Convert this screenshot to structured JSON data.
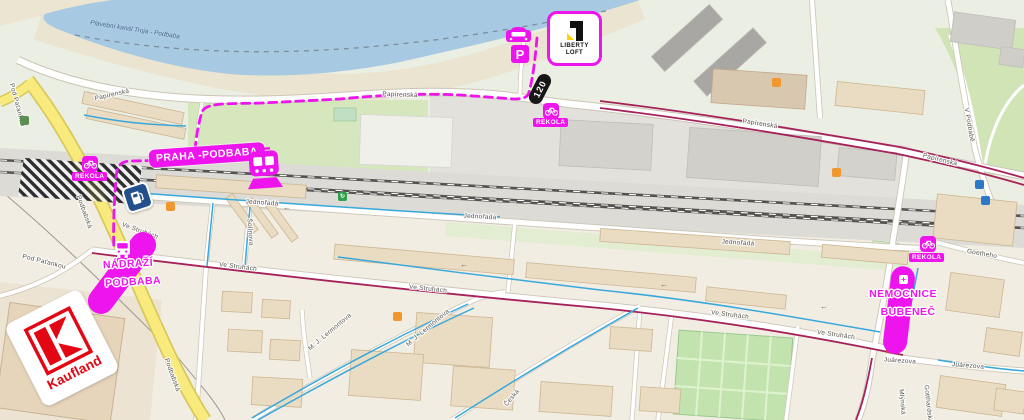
{
  "colors": {
    "accent": "#EE14EE",
    "river": "#A7C9E2",
    "yellow_road": "#F8EA7D",
    "yellow_casing": "#D9C85A",
    "cycle_maroon": "#A6215A",
    "cycle_blue": "#38A8DC",
    "kaufland_red": "#E30613",
    "fuel_blue": "#23508C",
    "railway": "#53524E"
  },
  "map": {
    "river_label": "Plavební kanál Troja - Podbaba"
  },
  "markers": {
    "praha_podbaba": {
      "label": "PRAHA -PODBABA"
    },
    "nadrazi_podbaba": {
      "line1": "NÁDRAŽÍ",
      "line2": "PODBABA"
    },
    "nemocnice_bubenec": {
      "line1": "NEMOCNICE",
      "line2": "BUBENEČ"
    },
    "rekola_top": {
      "label": "REKOLA"
    },
    "rekola_left": {
      "label": "REKOLA"
    },
    "rekola_right": {
      "label": "REKOLA"
    },
    "liberty_loft": {
      "line1": "LIBERTY",
      "line2": "LOFT"
    },
    "route_120": {
      "label": "120"
    },
    "parking": {
      "label": "P"
    },
    "kaufland": {
      "label": "Kaufland"
    }
  },
  "street_labels": [
    {
      "text": "Papírenská",
      "x": 112,
      "y": 95,
      "rot": -13
    },
    {
      "text": "Papírenská",
      "x": 400,
      "y": 95,
      "rot": 2
    },
    {
      "text": "Papírenská",
      "x": 760,
      "y": 124,
      "rot": 9
    },
    {
      "text": "Papírenská",
      "x": 940,
      "y": 160,
      "rot": 14
    },
    {
      "text": "Jednořadá",
      "x": 262,
      "y": 203,
      "rot": 4
    },
    {
      "text": "Jednořadá",
      "x": 480,
      "y": 217,
      "rot": 3
    },
    {
      "text": "Jednořadá",
      "x": 738,
      "y": 243,
      "rot": 4
    },
    {
      "text": "Ve Struhách",
      "x": 140,
      "y": 231,
      "rot": 20
    },
    {
      "text": "Ve Struhách",
      "x": 238,
      "y": 267,
      "rot": 7
    },
    {
      "text": "Ve Struhách",
      "x": 428,
      "y": 289,
      "rot": 6
    },
    {
      "text": "Ve Struhách",
      "x": 730,
      "y": 315,
      "rot": 7
    },
    {
      "text": "Ve Struhách",
      "x": 836,
      "y": 335,
      "rot": 8
    },
    {
      "text": "Podbabská",
      "x": 84,
      "y": 212,
      "rot": 70
    },
    {
      "text": "Podbabská",
      "x": 172,
      "y": 375,
      "rot": 70
    },
    {
      "text": "Pod Paťankou",
      "x": 17,
      "y": 105,
      "rot": 75
    },
    {
      "text": "Pod Paťankou",
      "x": 44,
      "y": 262,
      "rot": 14
    },
    {
      "text": "Šolínova",
      "x": 250,
      "y": 232,
      "rot": 86
    },
    {
      "text": "M. J. Lermontova",
      "x": 330,
      "y": 332,
      "rot": -40
    },
    {
      "text": "M. J. Lermontova",
      "x": 428,
      "y": 328,
      "rot": -40
    },
    {
      "text": "Česká",
      "x": 512,
      "y": 398,
      "rot": -50
    },
    {
      "text": "Juárezova",
      "x": 900,
      "y": 361,
      "rot": 4
    },
    {
      "text": "Juárezova",
      "x": 968,
      "y": 366,
      "rot": 5
    },
    {
      "text": "Goetheho",
      "x": 982,
      "y": 254,
      "rot": 10
    },
    {
      "text": "Mlýnská",
      "x": 902,
      "y": 402,
      "rot": 85
    },
    {
      "text": "Gotthardská",
      "x": 928,
      "y": 404,
      "rot": 84
    },
    {
      "text": "V Podbabě",
      "x": 969,
      "y": 125,
      "rot": 80
    }
  ],
  "poi_icons": [
    {
      "name": "recycling-icon",
      "x": 338,
      "y": 192,
      "bg": "#2FA04C",
      "glyph": "↻"
    },
    {
      "name": "shop-icon",
      "x": 166,
      "y": 202,
      "bg": "#F0972E",
      "glyph": ""
    },
    {
      "name": "shop-icon",
      "x": 393,
      "y": 312,
      "bg": "#F0972E",
      "glyph": ""
    },
    {
      "name": "shop-icon",
      "x": 772,
      "y": 78,
      "bg": "#F0972E",
      "glyph": ""
    },
    {
      "name": "shop-icon",
      "x": 832,
      "y": 168,
      "bg": "#F0972E",
      "glyph": ""
    },
    {
      "name": "transit-icon",
      "x": 975,
      "y": 180,
      "bg": "#2D78C8",
      "glyph": ""
    },
    {
      "name": "transit-icon",
      "x": 981,
      "y": 196,
      "bg": "#2D78C8",
      "glyph": ""
    },
    {
      "name": "poi-icon",
      "x": 886,
      "y": 344,
      "bg": "#C44536",
      "glyph": ""
    },
    {
      "name": "tree-icon",
      "x": 20,
      "y": 116,
      "bg": "#5B8F52",
      "glyph": ""
    },
    {
      "name": "parking-small-icon",
      "x": 66,
      "y": 372,
      "bg": "#2E6DB4",
      "glyph": "P"
    },
    {
      "name": "oneway-arrow-icon",
      "x": 283,
      "y": 204,
      "bg": "none",
      "glyph": "←"
    },
    {
      "name": "oneway-arrow-icon",
      "x": 460,
      "y": 261,
      "bg": "none",
      "glyph": "←"
    },
    {
      "name": "oneway-arrow-icon",
      "x": 660,
      "y": 281,
      "bg": "none",
      "glyph": "←"
    },
    {
      "name": "oneway-arrow-icon",
      "x": 820,
      "y": 303,
      "bg": "none",
      "glyph": "←"
    }
  ]
}
